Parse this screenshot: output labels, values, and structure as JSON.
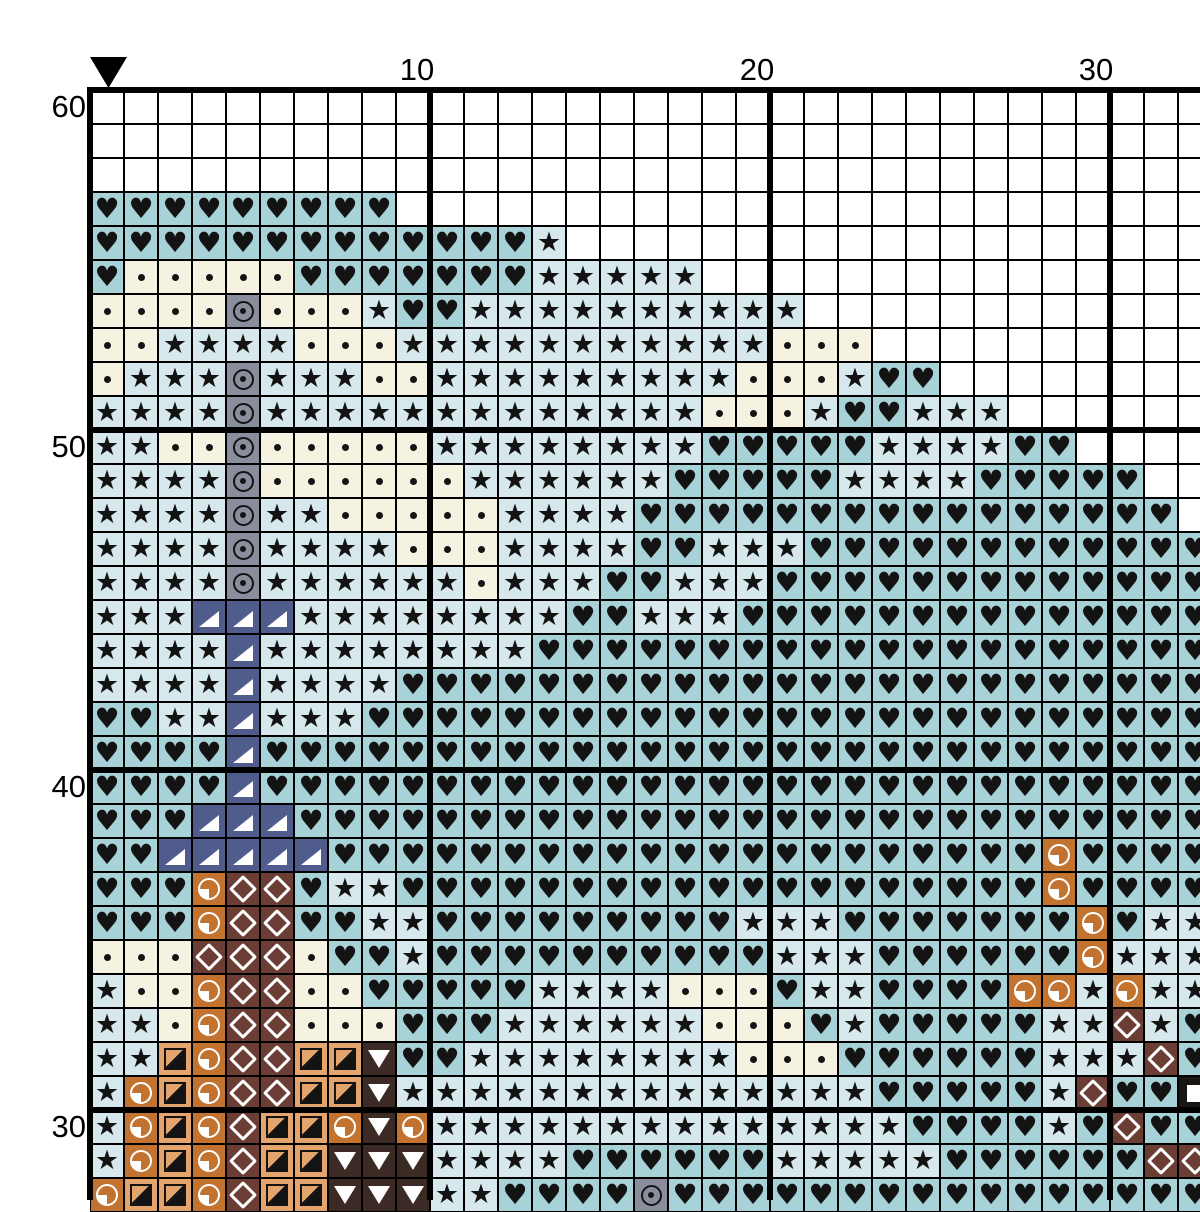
{
  "page": {
    "background": "#ffffff",
    "grid_line_color": "#000000",
    "kind": "cross-stitch pattern chart (top-right section of a larger pattern)"
  },
  "ruler": {
    "top_labels": [
      "10",
      "20",
      "30"
    ],
    "left_labels": [
      "60",
      "50",
      "40",
      "30"
    ]
  },
  "marker": {
    "shape": "black triangle pointing down",
    "marks": "center column indicator above column 0",
    "color": "#000000"
  },
  "chart_data": {
    "type": "heatmap",
    "title": "",
    "description": "Cross-stitch chart grid. Each cell is one stitch: a symbol code mapped by the palette. Rows are labeled top-to-bottom 60 down to 28 (bottom row partially visible); columns 0-32 left-to-right (column 32 partially visible). Thick gridlines every 10 cells at column lines 0/10/20/30 and row lines 60/50/40/30.",
    "columns": 33,
    "rows_count": 33,
    "first_row_label": 60,
    "last_row_label": 28,
    "cell_px": 34,
    "origin_px": [
      90,
      90
    ],
    "palette": {
      ".": {
        "symbol": "empty",
        "bg": "#ffffff",
        "glyph": ""
      },
      "h": {
        "symbol": "heart",
        "bg": "#a7d2d7",
        "glyph": "♥"
      },
      "s": {
        "symbol": "star",
        "bg": "#d7e8ec",
        "glyph": "★"
      },
      "d": {
        "symbol": "dot",
        "bg": "#f6f2e2",
        "glyph": ""
      },
      "o": {
        "symbol": "circle-dot",
        "bg": "#8a8e9c",
        "glyph": ""
      },
      "t": {
        "symbol": "triangle-corner",
        "bg": "#4f5c8c",
        "glyph": ""
      },
      "q": {
        "symbol": "quarter-circle",
        "bg": "#c37330",
        "glyph": ""
      },
      "m": {
        "symbol": "diamond",
        "bg": "#6b3d35",
        "glyph": ""
      },
      "f": {
        "symbol": "half-square",
        "bg": "#e3a46d",
        "glyph": ""
      },
      "v": {
        "symbol": "triangle-down",
        "bg": "#3c2b24",
        "glyph": ""
      },
      "w": {
        "symbol": "square",
        "bg": "#191512",
        "glyph": ""
      }
    },
    "rows": [
      ".................................",
      ".................................",
      ".................................",
      "hhhhhhhhh........................",
      "hhhhhhhhhhhhhs...................",
      "hdddddhhhhhhhsssss...............",
      "ddddodddshhssssssssss............",
      "ddssssdddsssssssssssddd..........",
      "dsssosssddsssssssssdddshh........",
      "ssssosssssssssssssdddshhsss......",
      "ssddodddddsssssssshhhhhsssshh....",
      "ssssoddddddsssssshhhhhsssshhhhh..",
      "ssssossdddddsssshhhhhhhhhhhhhhhh.",
      "ssssossssdddsssshhssshhhhhhhhhhhh",
      "ssssossssssdssshhssshhhhhhhhhhhhh",
      "ssstttsssssssshhssshhhhhhhhhhhhhh",
      "sssstsssssssshhhhhhhhhhhhhhhhhhhh",
      "sssstsssshhhhhhhhhhhhhhhhhhhhhhhh",
      "hhsstssshhhhhhhhhhhhhhhhhhhhhhhhh",
      "hhhhthhhhhhhhhhhhhhhhhhhhhhhhhhhh",
      "hhhhthhhhhhhhhhhhhhhhhhhhhhhhhhhh",
      "hhhttthhhhhhhhhhhhhhhhhhhhhhhhhhh",
      "hhttttthhhhhhhhhhhhhhhhhhhhhqhhhh",
      "hhhqmmhsshhhhhhhhhhhhhhhhhhhqhhhh",
      "hhhqmmhhsshhhhhhhhhssshhhhhhhqhss",
      "dddmmmdhhshhhhhhhhhhssshhhhhhqsss",
      "sddqmmddhhhhhssssdddhsshhhhqqsqss",
      "ssdqmmdddhhhssssssdddhshhhhhssmsh",
      "ssfqmmffvhhssssssssdddhhhhhhsssmh",
      "sqfqmmffvsssssssssssssshhhhhsmhhw",
      "sqfqmffqvqsssssssssssssshhhhshmhh",
      "sqfqmffvvvsssshhhhhhssssshhhhhhmm",
      "qffqmffvvvsshhhhohhhhhhhhhhhhhhhh"
    ]
  }
}
